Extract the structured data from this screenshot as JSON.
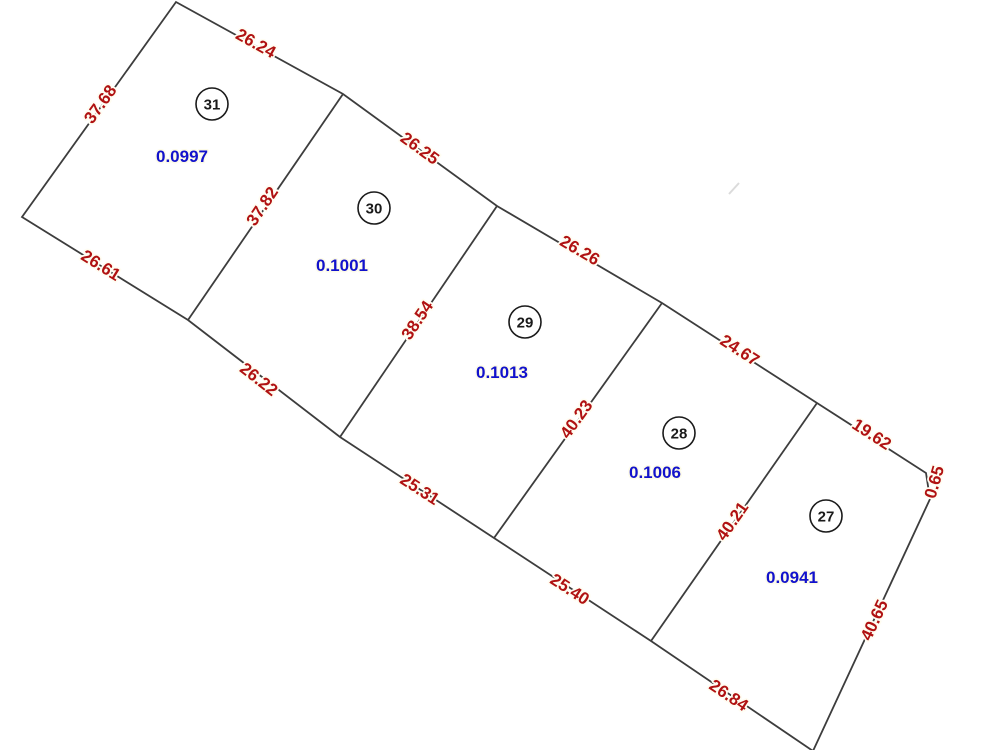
{
  "diagram_type": "survey-plat",
  "lots": [
    {
      "number": "31",
      "area": "0.0997"
    },
    {
      "number": "30",
      "area": "0.1001"
    },
    {
      "number": "29",
      "area": "0.1013"
    },
    {
      "number": "28",
      "area": "0.1006"
    },
    {
      "number": "27",
      "area": "0.0941"
    }
  ],
  "edges": {
    "left": "37.68",
    "top": [
      "26.24",
      "26.25",
      "26.26",
      "24.67",
      "19.62"
    ],
    "top_right": "0.65",
    "right": "40.65",
    "bottom": [
      "26.61",
      "26.22",
      "25.31",
      "25.40",
      "26.84"
    ],
    "dividers": [
      "37.82",
      "38.54",
      "40.23",
      "40.21"
    ]
  },
  "colors": {
    "dimension_text": "#b01212",
    "area_text": "#1212cc",
    "line": "#3d3d3d"
  }
}
